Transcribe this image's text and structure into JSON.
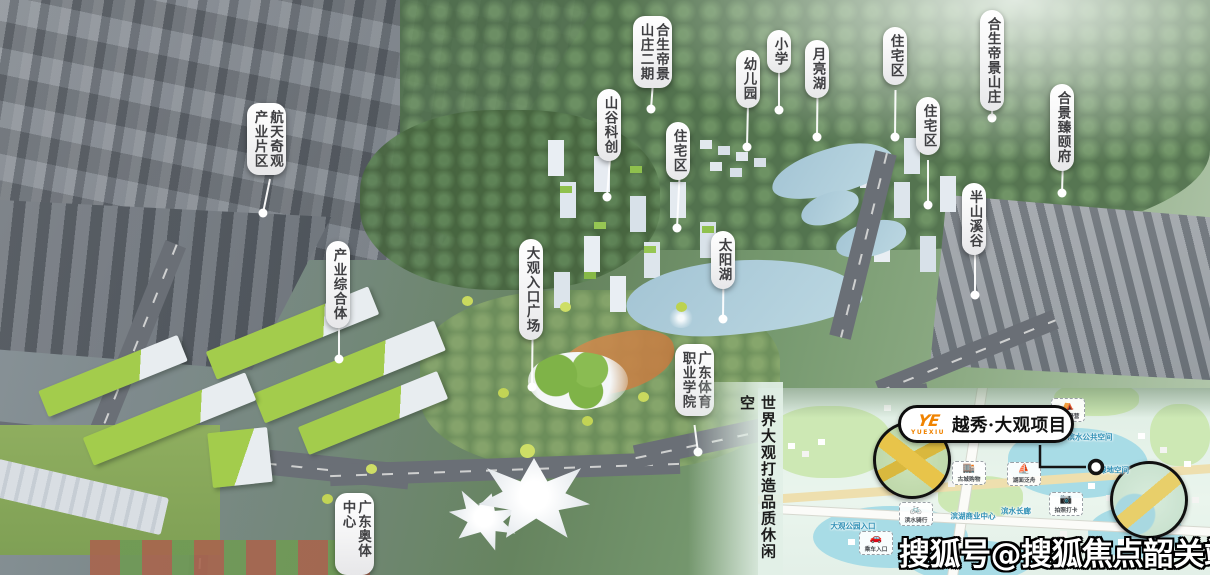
{
  "meta": {
    "width": 1210,
    "height": 575
  },
  "colors": {
    "accent_orange": "#f08300",
    "pill_background": "#ffffff",
    "pill_text": "#3f3f42",
    "leader_line": "#ffffff",
    "map_label_blue": "#2e8fb5",
    "slogan_text": "#1c1c1c",
    "watermark_fill": "#ffffff",
    "watermark_outline": "#000000"
  },
  "slogan": {
    "text": "世界大观打造品质休闲空"
  },
  "watermark": {
    "text": "搜狐号@搜狐焦点韶关站"
  },
  "callouts": [
    {
      "id": "hangtian-qiguan",
      "text": "航天奇观\n产业片区",
      "box": {
        "x": 247,
        "y": 103,
        "w": 46,
        "h": 80
      },
      "dot": {
        "x": 263,
        "y": 213
      }
    },
    {
      "id": "hesheng-dijing-erqi",
      "text": "合生帝景\n山庄二期",
      "box": {
        "x": 633,
        "y": 16,
        "w": 40,
        "h": 70
      },
      "dot": {
        "x": 651,
        "y": 109
      }
    },
    {
      "id": "shangu-kechuang",
      "text": "山谷科创",
      "box": {
        "x": 597,
        "y": 89,
        "w": 27,
        "h": 67
      },
      "dot": {
        "x": 607,
        "y": 197
      }
    },
    {
      "id": "zhuzhaiqu-1",
      "text": "住宅区",
      "box": {
        "x": 666,
        "y": 122,
        "w": 27,
        "h": 59
      },
      "dot": {
        "x": 677,
        "y": 228
      }
    },
    {
      "id": "youeryuan",
      "text": "幼儿园",
      "box": {
        "x": 736,
        "y": 50,
        "w": 24,
        "h": 57
      },
      "dot": {
        "x": 747,
        "y": 147
      }
    },
    {
      "id": "xiaoxue",
      "text": "小学",
      "box": {
        "x": 767,
        "y": 30,
        "w": 24,
        "h": 45
      },
      "dot": {
        "x": 779,
        "y": 110
      }
    },
    {
      "id": "yueliang-hu",
      "text": "月亮湖",
      "box": {
        "x": 805,
        "y": 40,
        "w": 25,
        "h": 55
      },
      "dot": {
        "x": 817,
        "y": 137
      }
    },
    {
      "id": "zhuzhaiqu-2",
      "text": "住宅区",
      "box": {
        "x": 883,
        "y": 27,
        "w": 25,
        "h": 67
      },
      "dot": {
        "x": 895,
        "y": 137
      }
    },
    {
      "id": "hesheng-dijing-shanzhuang",
      "text": "合生帝景山庄",
      "box": {
        "x": 980,
        "y": 10,
        "w": 25,
        "h": 88
      },
      "dot": {
        "x": 992,
        "y": 118
      }
    },
    {
      "id": "hejing-zhenyifu",
      "text": "合景臻颐府",
      "box": {
        "x": 1050,
        "y": 84,
        "w": 26,
        "h": 79
      },
      "dot": {
        "x": 1062,
        "y": 193
      }
    },
    {
      "id": "zhuzhaiqu-3",
      "text": "住宅区",
      "box": {
        "x": 916,
        "y": 97,
        "w": 24,
        "h": 67
      },
      "dot": {
        "x": 928,
        "y": 205
      }
    },
    {
      "id": "banshan-xigu",
      "text": "半山溪谷",
      "box": {
        "x": 962,
        "y": 183,
        "w": 26,
        "h": 66
      },
      "dot": {
        "x": 975,
        "y": 295
      }
    },
    {
      "id": "taiyang-hu",
      "text": "太阳湖",
      "box": {
        "x": 711,
        "y": 231,
        "w": 25,
        "h": 44
      },
      "dot": {
        "x": 723,
        "y": 319
      }
    },
    {
      "id": "chanye-zongheti",
      "text": "产业综合体",
      "box": {
        "x": 326,
        "y": 241,
        "w": 26,
        "h": 76
      },
      "dot": {
        "x": 339,
        "y": 359
      }
    },
    {
      "id": "daguan-rukou-guangchang",
      "text": "大观入口广场",
      "box": {
        "x": 519,
        "y": 239,
        "w": 27,
        "h": 105
      },
      "dot": {
        "x": 532,
        "y": 387
      }
    },
    {
      "id": "guangdong-tiyu-xueyuan",
      "text": "广东体育\n职业学院",
      "box": {
        "x": 675,
        "y": 344,
        "w": 39,
        "h": 85
      },
      "dot": {
        "x": 698,
        "y": 452
      }
    },
    {
      "id": "guangdong-aoti-zhongxin",
      "text": "广东奥体中心",
      "box": {
        "x": 335,
        "y": 493,
        "w": 26,
        "h": 90
      },
      "dot": null
    }
  ],
  "inset": {
    "x": 758,
    "y": 388,
    "w": 452,
    "h": 187,
    "brand": {
      "logo_monogram": "YE",
      "logo_sub": "YUEXIU",
      "title": "越秀·大观项目"
    },
    "connector": {
      "points": [
        [
          282,
          57
        ],
        [
          282,
          79
        ],
        [
          328,
          79
        ]
      ],
      "marker": {
        "x": 338,
        "y": 79
      }
    },
    "labels": [
      {
        "text": "滨水公共空间",
        "x": 332,
        "y": 49
      },
      {
        "text": "绿地空间",
        "x": 356,
        "y": 82
      },
      {
        "text": "滨湖商业中心",
        "x": 215,
        "y": 128
      },
      {
        "text": "大观公园入口",
        "x": 95,
        "y": 138
      },
      {
        "text": "滨水长廊",
        "x": 258,
        "y": 123
      }
    ],
    "badges": [
      {
        "icon": "tent",
        "glyph": "⛺",
        "text": "房车野营",
        "x": 310,
        "y": 22
      },
      {
        "icon": "camera",
        "glyph": "📷",
        "text": "拍照打卡",
        "x": 308,
        "y": 116
      },
      {
        "icon": "bike",
        "glyph": "🚲",
        "text": "滨水骑行",
        "x": 158,
        "y": 126
      },
      {
        "icon": "shop",
        "glyph": "🏬",
        "text": "古城购物",
        "x": 211,
        "y": 85
      },
      {
        "icon": "boat",
        "glyph": "⛵",
        "text": "湖面泛舟",
        "x": 266,
        "y": 86
      },
      {
        "icon": "car",
        "glyph": "🚗",
        "text": "乘车入口",
        "x": 118,
        "y": 155
      }
    ]
  }
}
